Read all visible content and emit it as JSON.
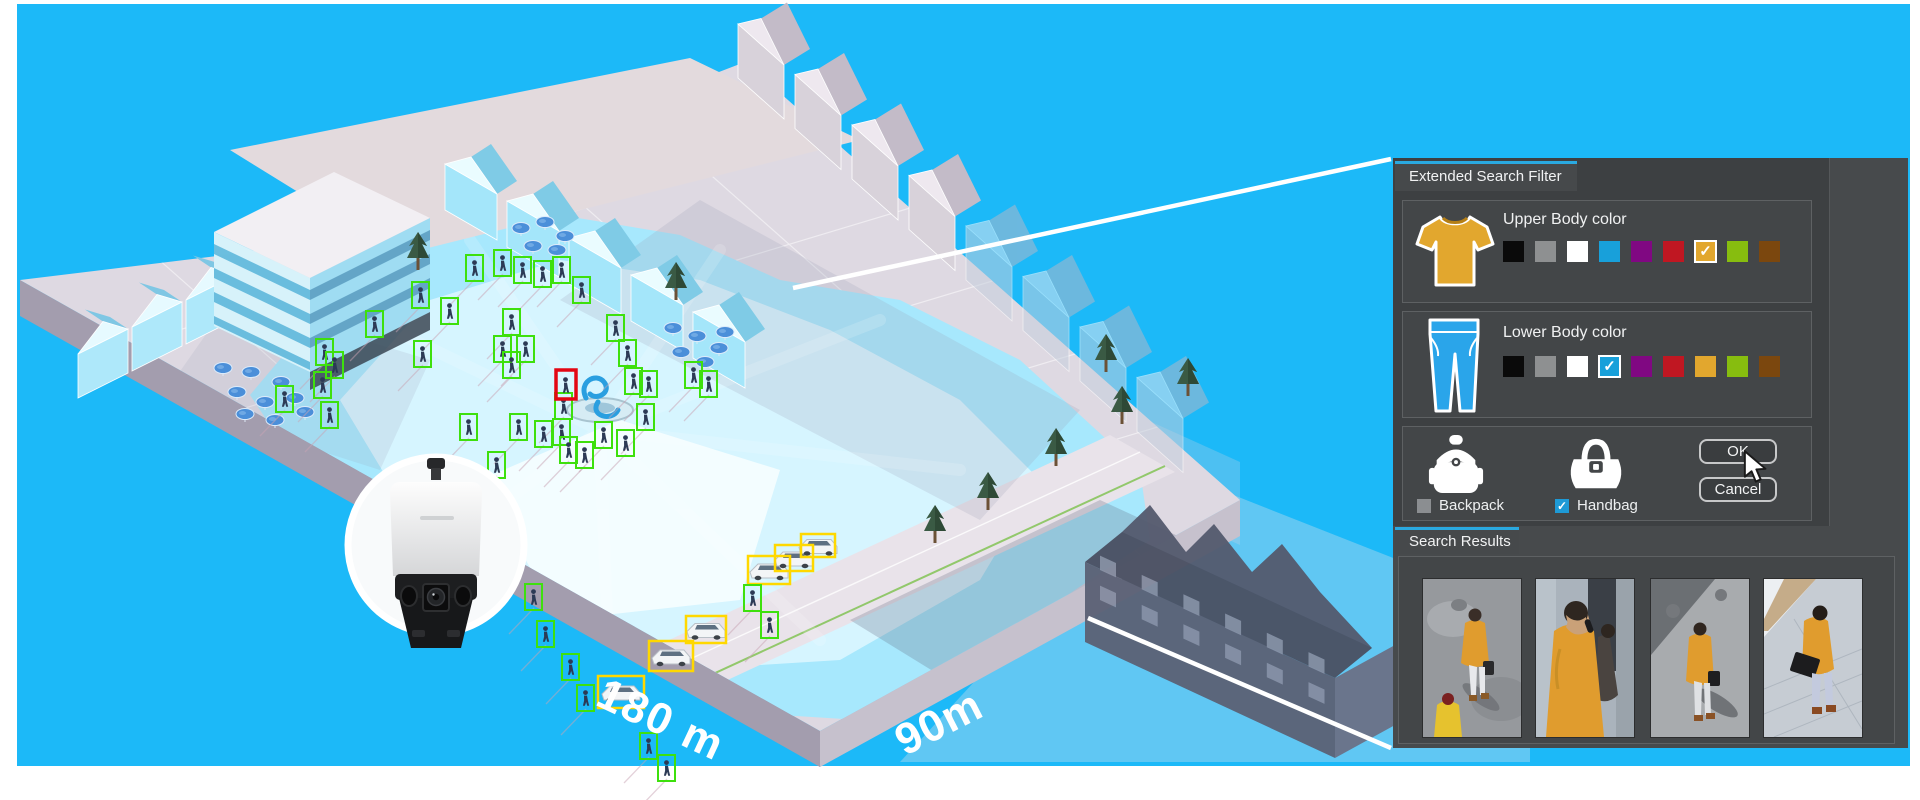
{
  "scene": {
    "bg_color": "#1cb9f8",
    "width_label": "180 m",
    "depth_label": "90m",
    "camera_icon": "multi-sensor-panoramic-camera",
    "detections": {
      "person_box_color": "#3ee00d",
      "vehicle_box_color": "#ffd800",
      "target_box_color": "#e30613",
      "persons": [
        [
          466,
          255
        ],
        [
          494,
          250
        ],
        [
          514,
          257
        ],
        [
          534,
          261
        ],
        [
          553,
          257
        ],
        [
          573,
          277
        ],
        [
          412,
          282
        ],
        [
          441,
          298
        ],
        [
          366,
          311
        ],
        [
          414,
          341
        ],
        [
          316,
          339
        ],
        [
          326,
          352
        ],
        [
          314,
          372
        ],
        [
          276,
          386
        ],
        [
          321,
          402
        ],
        [
          503,
          309
        ],
        [
          494,
          336
        ],
        [
          503,
          352
        ],
        [
          517,
          336
        ],
        [
          607,
          315
        ],
        [
          619,
          340
        ],
        [
          625,
          368
        ],
        [
          640,
          371
        ],
        [
          637,
          404
        ],
        [
          617,
          430
        ],
        [
          460,
          414
        ],
        [
          510,
          414
        ],
        [
          535,
          421
        ],
        [
          553,
          419
        ],
        [
          560,
          437
        ],
        [
          576,
          442
        ],
        [
          555,
          393
        ],
        [
          595,
          422
        ],
        [
          685,
          362
        ],
        [
          700,
          371
        ],
        [
          488,
          452
        ],
        [
          470,
          482
        ],
        [
          525,
          584
        ],
        [
          537,
          621
        ],
        [
          562,
          654
        ],
        [
          577,
          685
        ],
        [
          640,
          733
        ],
        [
          658,
          755
        ],
        [
          744,
          585
        ],
        [
          761,
          612
        ]
      ],
      "vehicles": [
        [
          598,
          676,
          46,
          32
        ],
        [
          649,
          641,
          44,
          30
        ],
        [
          686,
          616,
          40,
          27
        ],
        [
          748,
          556,
          42,
          28
        ],
        [
          775,
          545,
          38,
          26
        ],
        [
          801,
          534,
          34,
          23
        ]
      ],
      "target": [
        556,
        370,
        20,
        29
      ]
    }
  },
  "panel": {
    "accent_color": "#2aa9e0",
    "filter_tab_label": "Extended Search Filter",
    "results_tab_label": "Search Results",
    "upper_body": {
      "title": "Upper Body color",
      "colors": [
        "#0a0a0a",
        "#8e9091",
        "#ffffff",
        "#18a0da",
        "#800882",
        "#c01722",
        "#e2a72e",
        "#87bd0f",
        "#7b470e"
      ],
      "selected_index": 6
    },
    "lower_body": {
      "title": "Lower Body color",
      "colors": [
        "#0a0a0a",
        "#8e9091",
        "#ffffff",
        "#18a0da",
        "#800882",
        "#c01722",
        "#e2a72e",
        "#87bd0f",
        "#7b470e"
      ],
      "selected_index": 3
    },
    "accessories": {
      "backpack": {
        "label": "Backpack",
        "checked": false
      },
      "handbag": {
        "label": "Handbag",
        "checked": true
      }
    },
    "ok_label": "OK",
    "cancel_label": "Cancel",
    "results": {
      "thumbnails": [
        "person-orange-coat-overhead",
        "person-orange-coat-phone",
        "person-orange-coat-handbag-overhead",
        "person-orange-jacket-briefcase-overhead"
      ]
    }
  }
}
